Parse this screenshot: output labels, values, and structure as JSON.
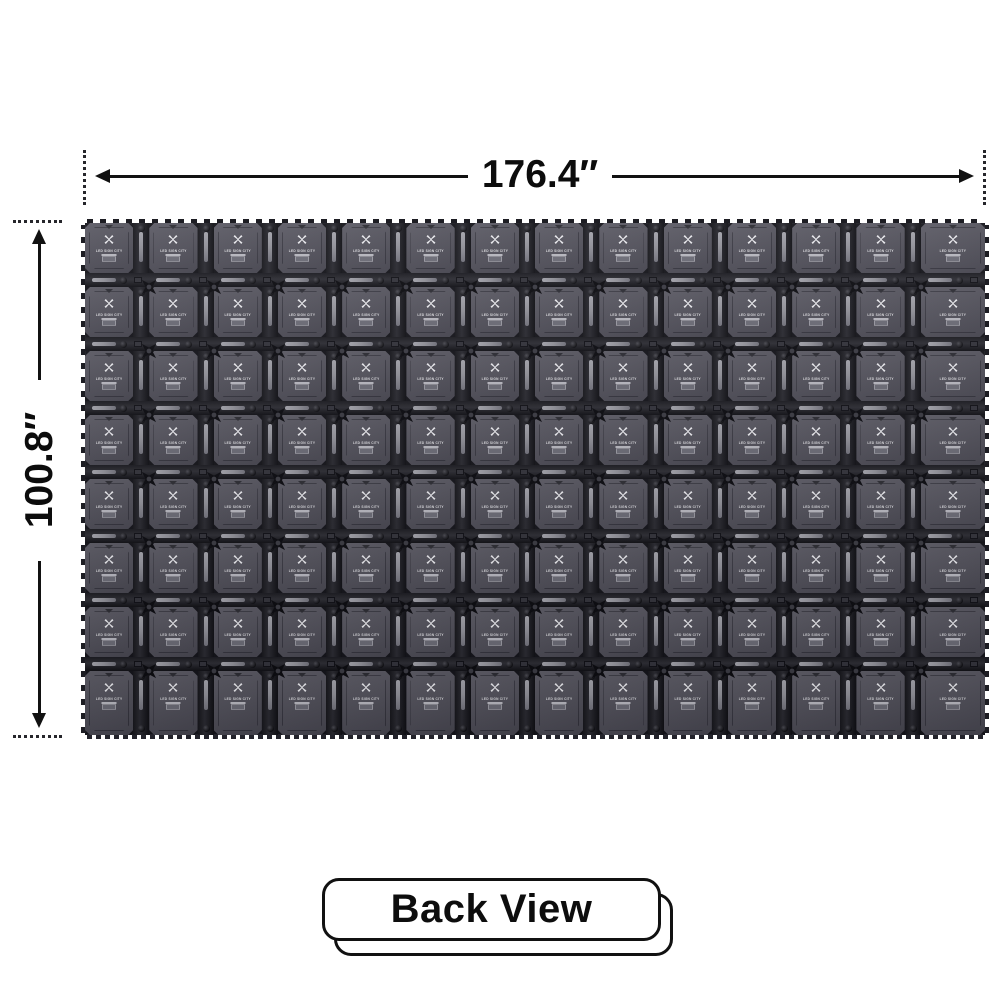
{
  "product_view": {
    "width_label": "176.4″",
    "height_label": "100.8″",
    "view_label": "Back View"
  },
  "panel_wall": {
    "rows": 8,
    "columns": 14,
    "brand_text": "LED SIGN CITY",
    "colors": {
      "panel_face": "#504f59",
      "connector": "#101015",
      "handle_bar": "#8f8f97",
      "logo": "#e8e8ec",
      "dimension_ink": "#111111"
    }
  }
}
